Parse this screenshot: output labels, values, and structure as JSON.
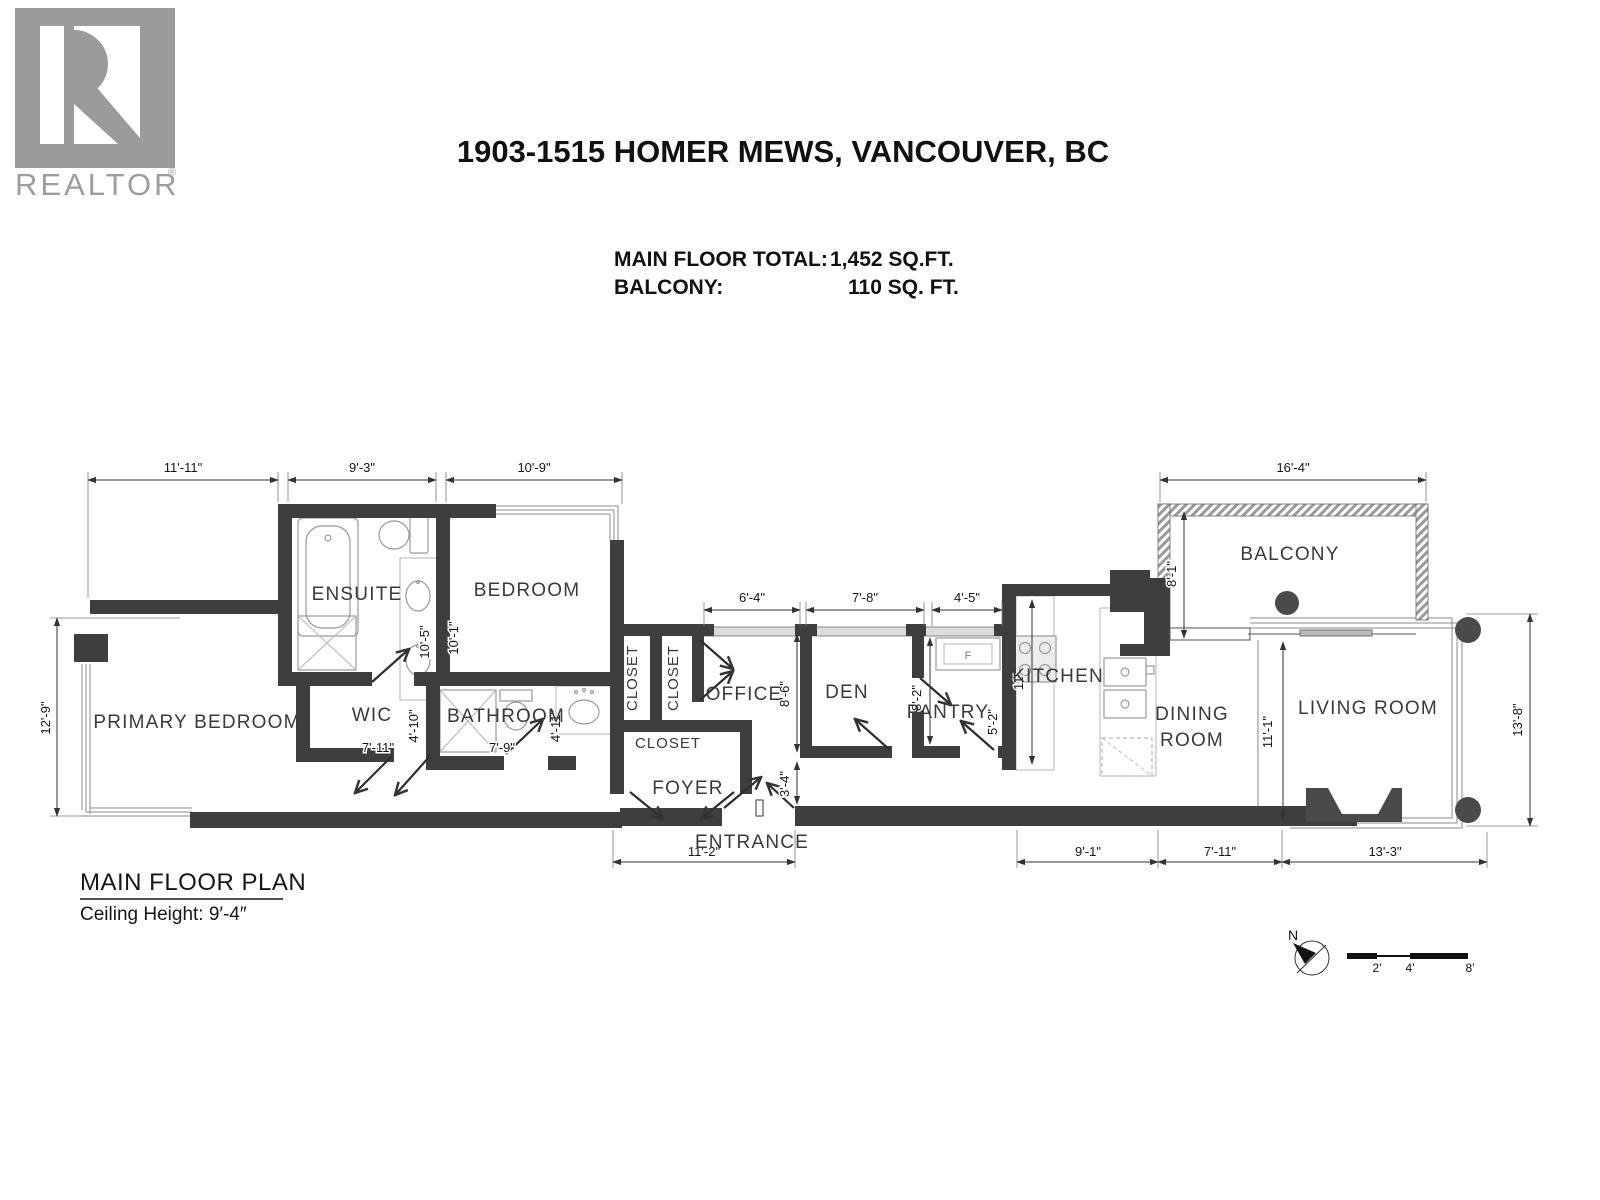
{
  "branding": {
    "logo_word": "REALTOR",
    "logo_reg": "®"
  },
  "header": {
    "title": "1903-1515 HOMER MEWS, VANCOUVER, BC",
    "area_rows": [
      {
        "label": "MAIN FLOOR TOTAL:",
        "value": "1,452 SQ.FT."
      },
      {
        "label": "BALCONY:",
        "value": "110 SQ. FT."
      }
    ]
  },
  "rooms": {
    "primary_bedroom": "PRIMARY BEDROOM",
    "ensuite": "ENSUITE",
    "wic": "WIC",
    "bathroom": "BATHROOM",
    "bedroom": "BEDROOM",
    "closet_1": "CLOSET",
    "closet_2": "CLOSET",
    "closet_3": "CLOSET",
    "office": "OFFICE",
    "foyer": "FOYER",
    "entrance": "ENTRANCE",
    "den": "DEN",
    "pantry": "PANTRY",
    "kitchen": "KITCHEN",
    "dining_line1": "DINING",
    "dining_line2": "ROOM",
    "balcony": "BALCONY",
    "living_room": "LIVING ROOM"
  },
  "fixtures": {
    "fridge": "F"
  },
  "dims": {
    "top_primary": "11'-11\"",
    "top_ensuite": "9'-3\"",
    "top_bedroom": "10'-9\"",
    "balcony_width": "16'-4\"",
    "office_width": "6'-4\"",
    "den_width": "7'-8\"",
    "pantry_width": "4'-5\"",
    "left_height": "12'-9\"",
    "ensuite_depth": "10'-5\"",
    "bedroom_depth": "10'-1\"",
    "wic_depth": "4'-10\"",
    "wic_width": "7'-11\"",
    "bath_width": "7'-9\"",
    "bath_depth": "4'-11\"",
    "office_depth": "8'-6\"",
    "entry_depth": "3'-4\"",
    "pantry_depth": "8'-2\"",
    "pantry_inner": "5'-2\"",
    "kitchen_depth": "11'",
    "balcony_side": "8'-1\"",
    "dining_depth": "11'-1\"",
    "living_depth": "13'-8\"",
    "foyer_width": "11'-2\"",
    "bottom_kitchen": "9'-1\"",
    "bottom_dining": "7'-11\"",
    "bottom_living": "13'-3\""
  },
  "footer": {
    "plan_name": "MAIN FLOOR PLAN",
    "ceiling": "Ceiling Height: 9′-4″",
    "north": "N",
    "scale_ticks": [
      "2'",
      "4'",
      "8'"
    ]
  },
  "colors": {
    "wall": "#3e3e3e",
    "logo_gray": "#9b9b9b"
  }
}
